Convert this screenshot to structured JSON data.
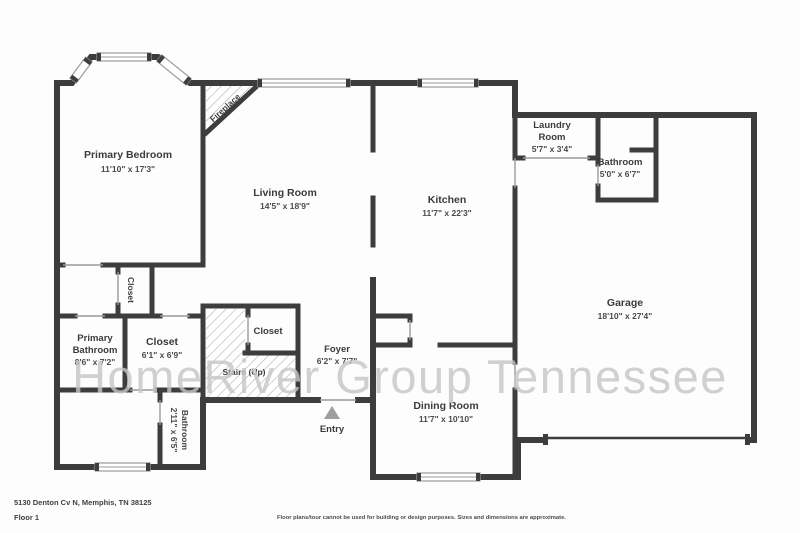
{
  "plan": {
    "watermark": "HomeRiver Group Tennessee",
    "rooms": {
      "primary_bedroom": {
        "name": "Primary Bedroom",
        "dims": "11'10\" x 17'3\""
      },
      "living_room": {
        "name": "Living Room",
        "dims": "14'5\" x 18'9\""
      },
      "kitchen": {
        "name": "Kitchen",
        "dims": "11'7\" x 22'3\""
      },
      "laundry": {
        "line1": "Laundry",
        "line2": "Room",
        "dims": "5'7\" x 3'4\""
      },
      "bathroom_top": {
        "name": "Bathroom",
        "dims": "5'0\" x 6'7\""
      },
      "garage": {
        "name": "Garage",
        "dims": "18'10\" x 27'4\""
      },
      "primary_bathroom": {
        "line1": "Primary",
        "line2": "Bathroom",
        "dims": "8'6\" x 7'2\""
      },
      "closet_main": {
        "name": "Closet",
        "dims": "6'1\" x 6'9\""
      },
      "closet_stairs": {
        "name": "Closet"
      },
      "closet_hall": {
        "name": "Closet"
      },
      "foyer": {
        "name": "Foyer",
        "dims": "6'2\" x 7'7\""
      },
      "dining_room": {
        "name": "Dining Room",
        "dims": "11'7\" x 10'10\""
      },
      "bathroom_small": {
        "name": "Bathroom",
        "dims": "2'11\" x 6'5\""
      }
    },
    "labels": {
      "stairs": "Stairs (Up)",
      "entry": "Entry",
      "fireplace": "Fireplace"
    }
  },
  "footer": {
    "address": "5130 Denton Cv N, Memphis, TN 38125",
    "floor": "Floor 1",
    "disclaimer": "Floor plans/tour cannot be used for building or design purposes. Sizes and dimensions are approximate."
  },
  "colors": {
    "wall": "#3d3d3d",
    "label": "#3b3b3b",
    "watermark": "#c6c6c6",
    "hatch": "#b8b8b8",
    "entry_arrow": "#9e9e9e"
  }
}
